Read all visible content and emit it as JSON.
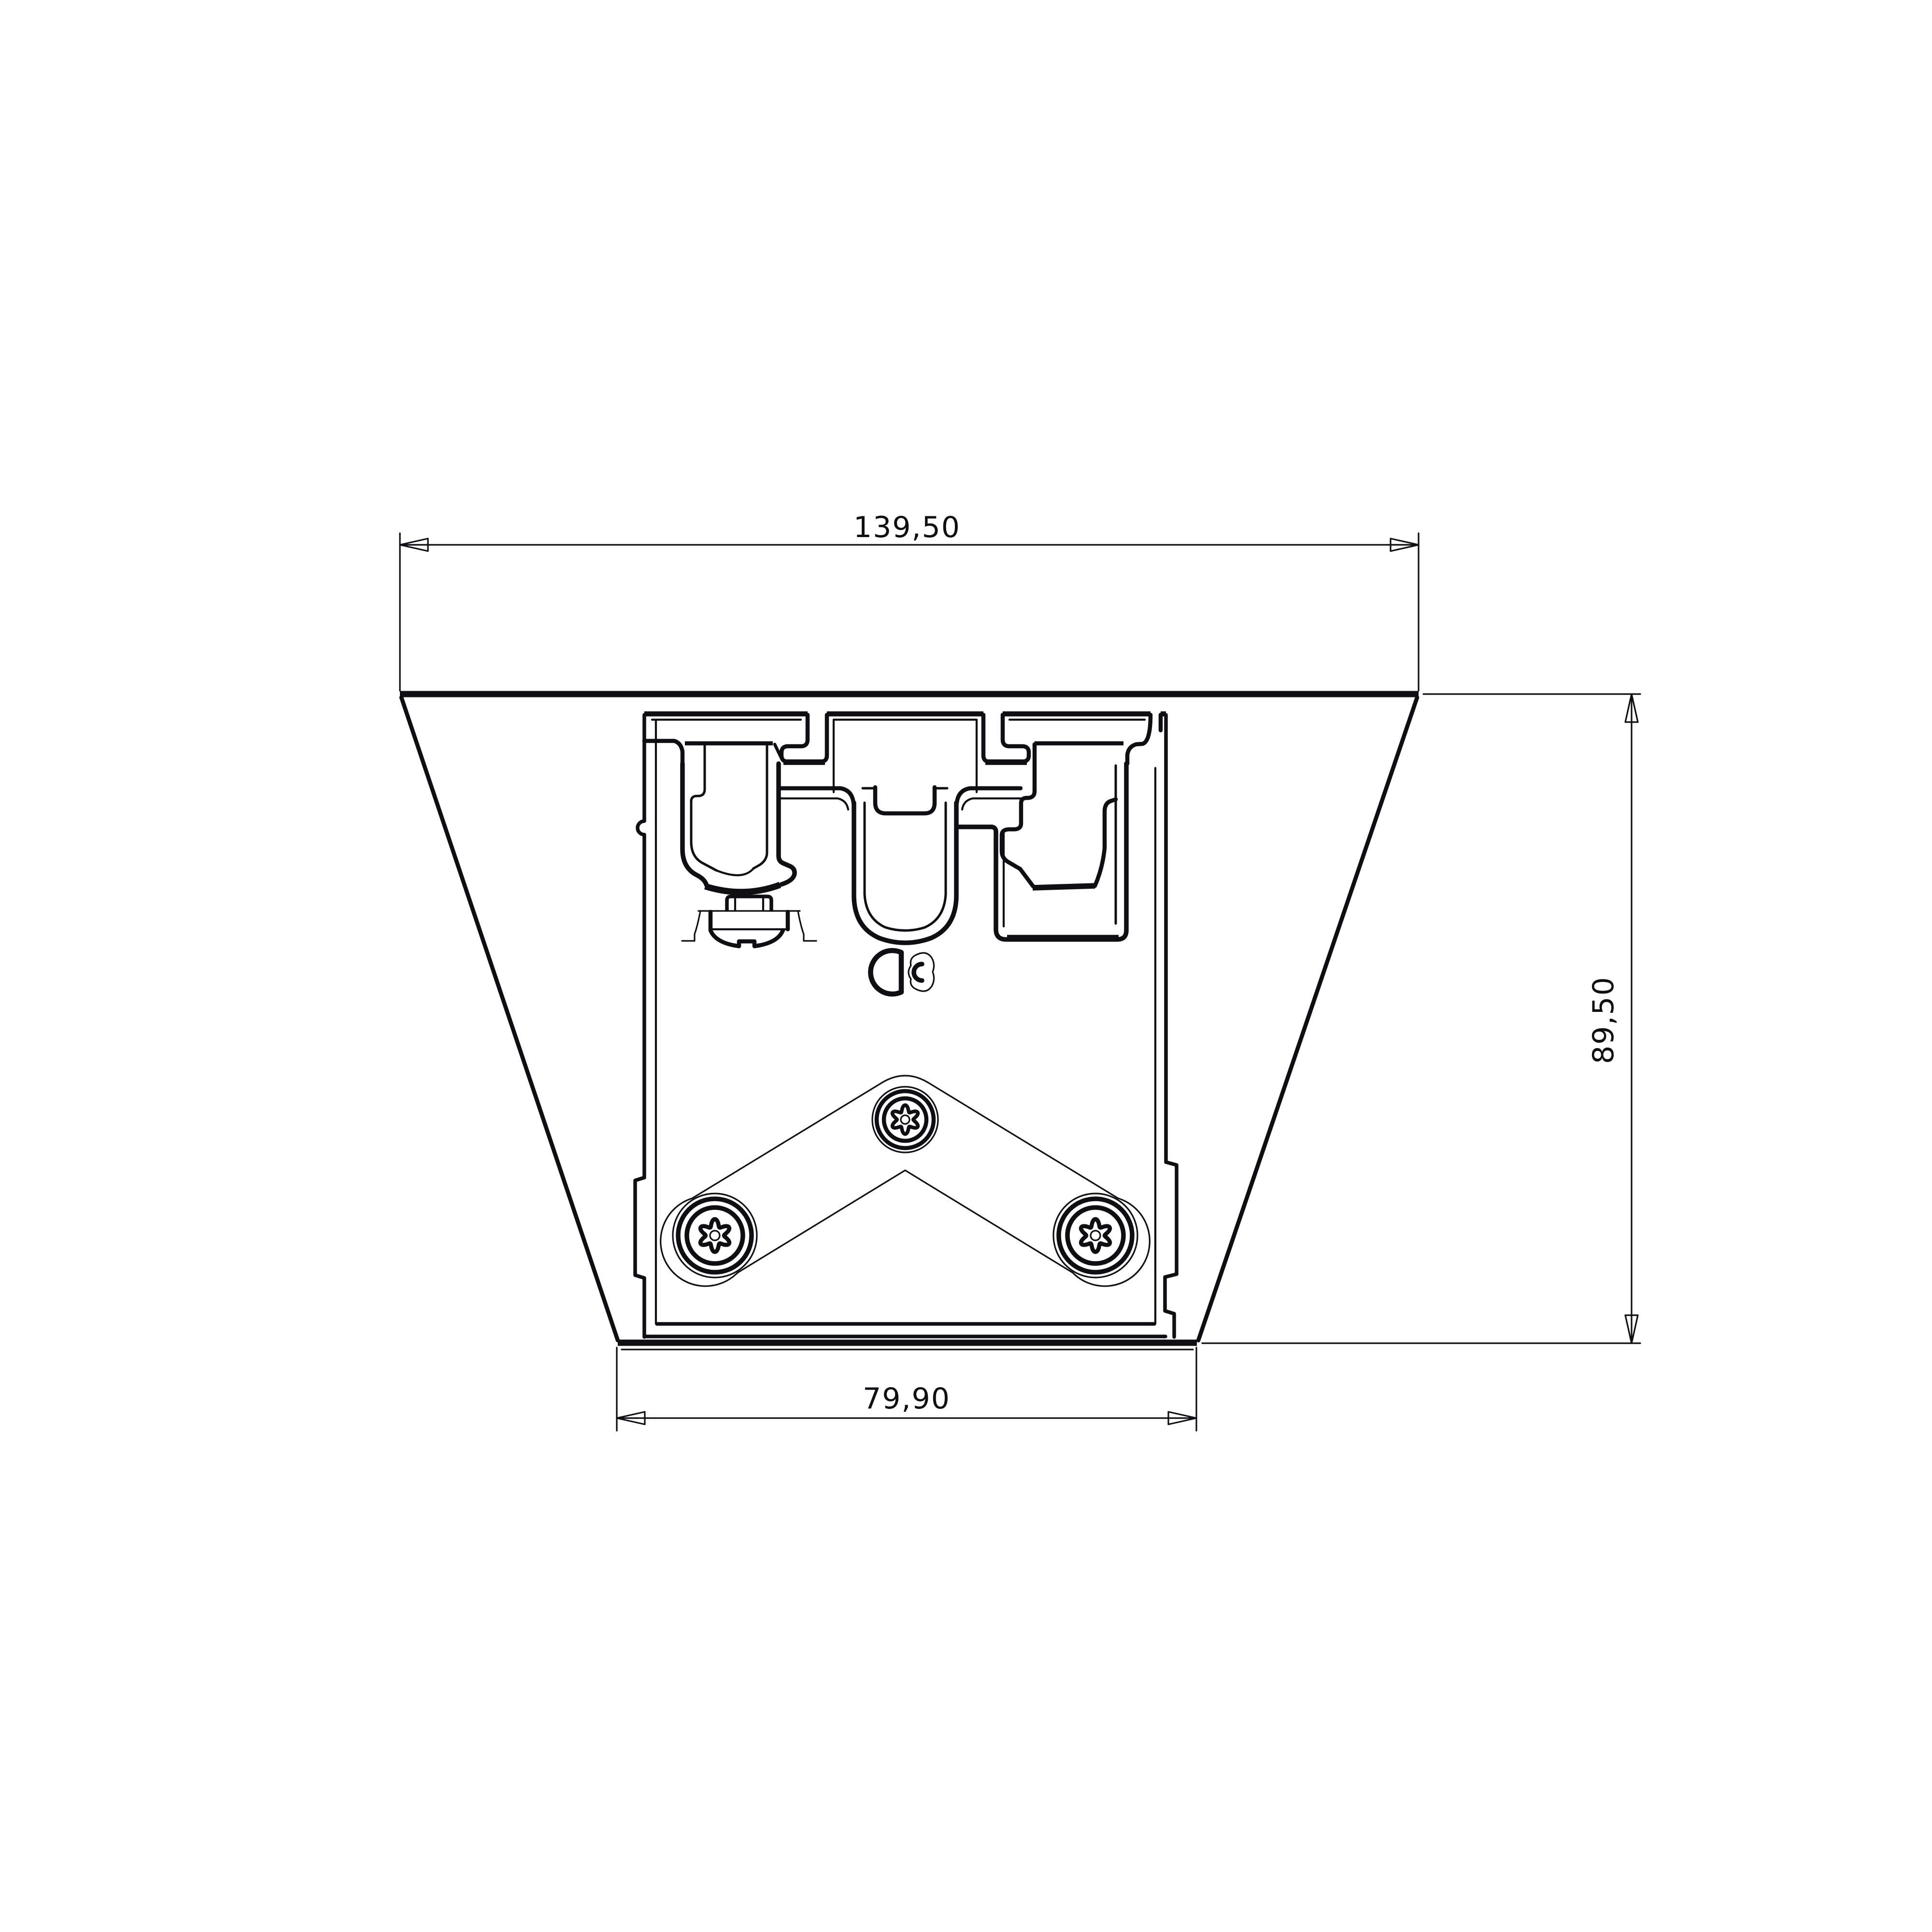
{
  "document": {
    "type": "technical-drawing",
    "view": "bracket-profile-cross-section",
    "units_style": "decimal-comma"
  },
  "colors": {
    "background": "#ffffff",
    "ink": "#0e0e13"
  },
  "dimensions": {
    "top_width": {
      "value": "139,50"
    },
    "right_height": {
      "value": "89,50"
    },
    "bottom_width": {
      "value": "79,90"
    }
  }
}
